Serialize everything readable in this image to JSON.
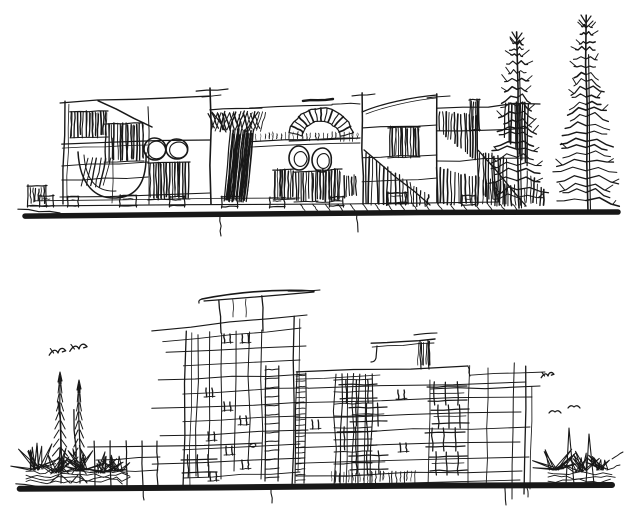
{
  "canvas": {
    "width": 640,
    "height": 509,
    "background_color": "#ffffff",
    "ink_color": "#181818"
  },
  "scene": {
    "type": "hand-drawn architectural elevation sketches, black ink on white",
    "sketches": [
      {
        "name": "top-building-elevation",
        "label": "low-rise facade sketch with hatched windows, radial arched entry, round and oval windows, hatched ramps, planters on a heavy ground line, two tall conifer trees at right"
      },
      {
        "name": "bottom-building-elevation",
        "label": "multi-storey block sketch with thin curved roof canopy, rooftop pergola, gridded windows, stair cores, heavy ground line, spiky shrubs, cypress trees and flying birds"
      }
    ]
  }
}
